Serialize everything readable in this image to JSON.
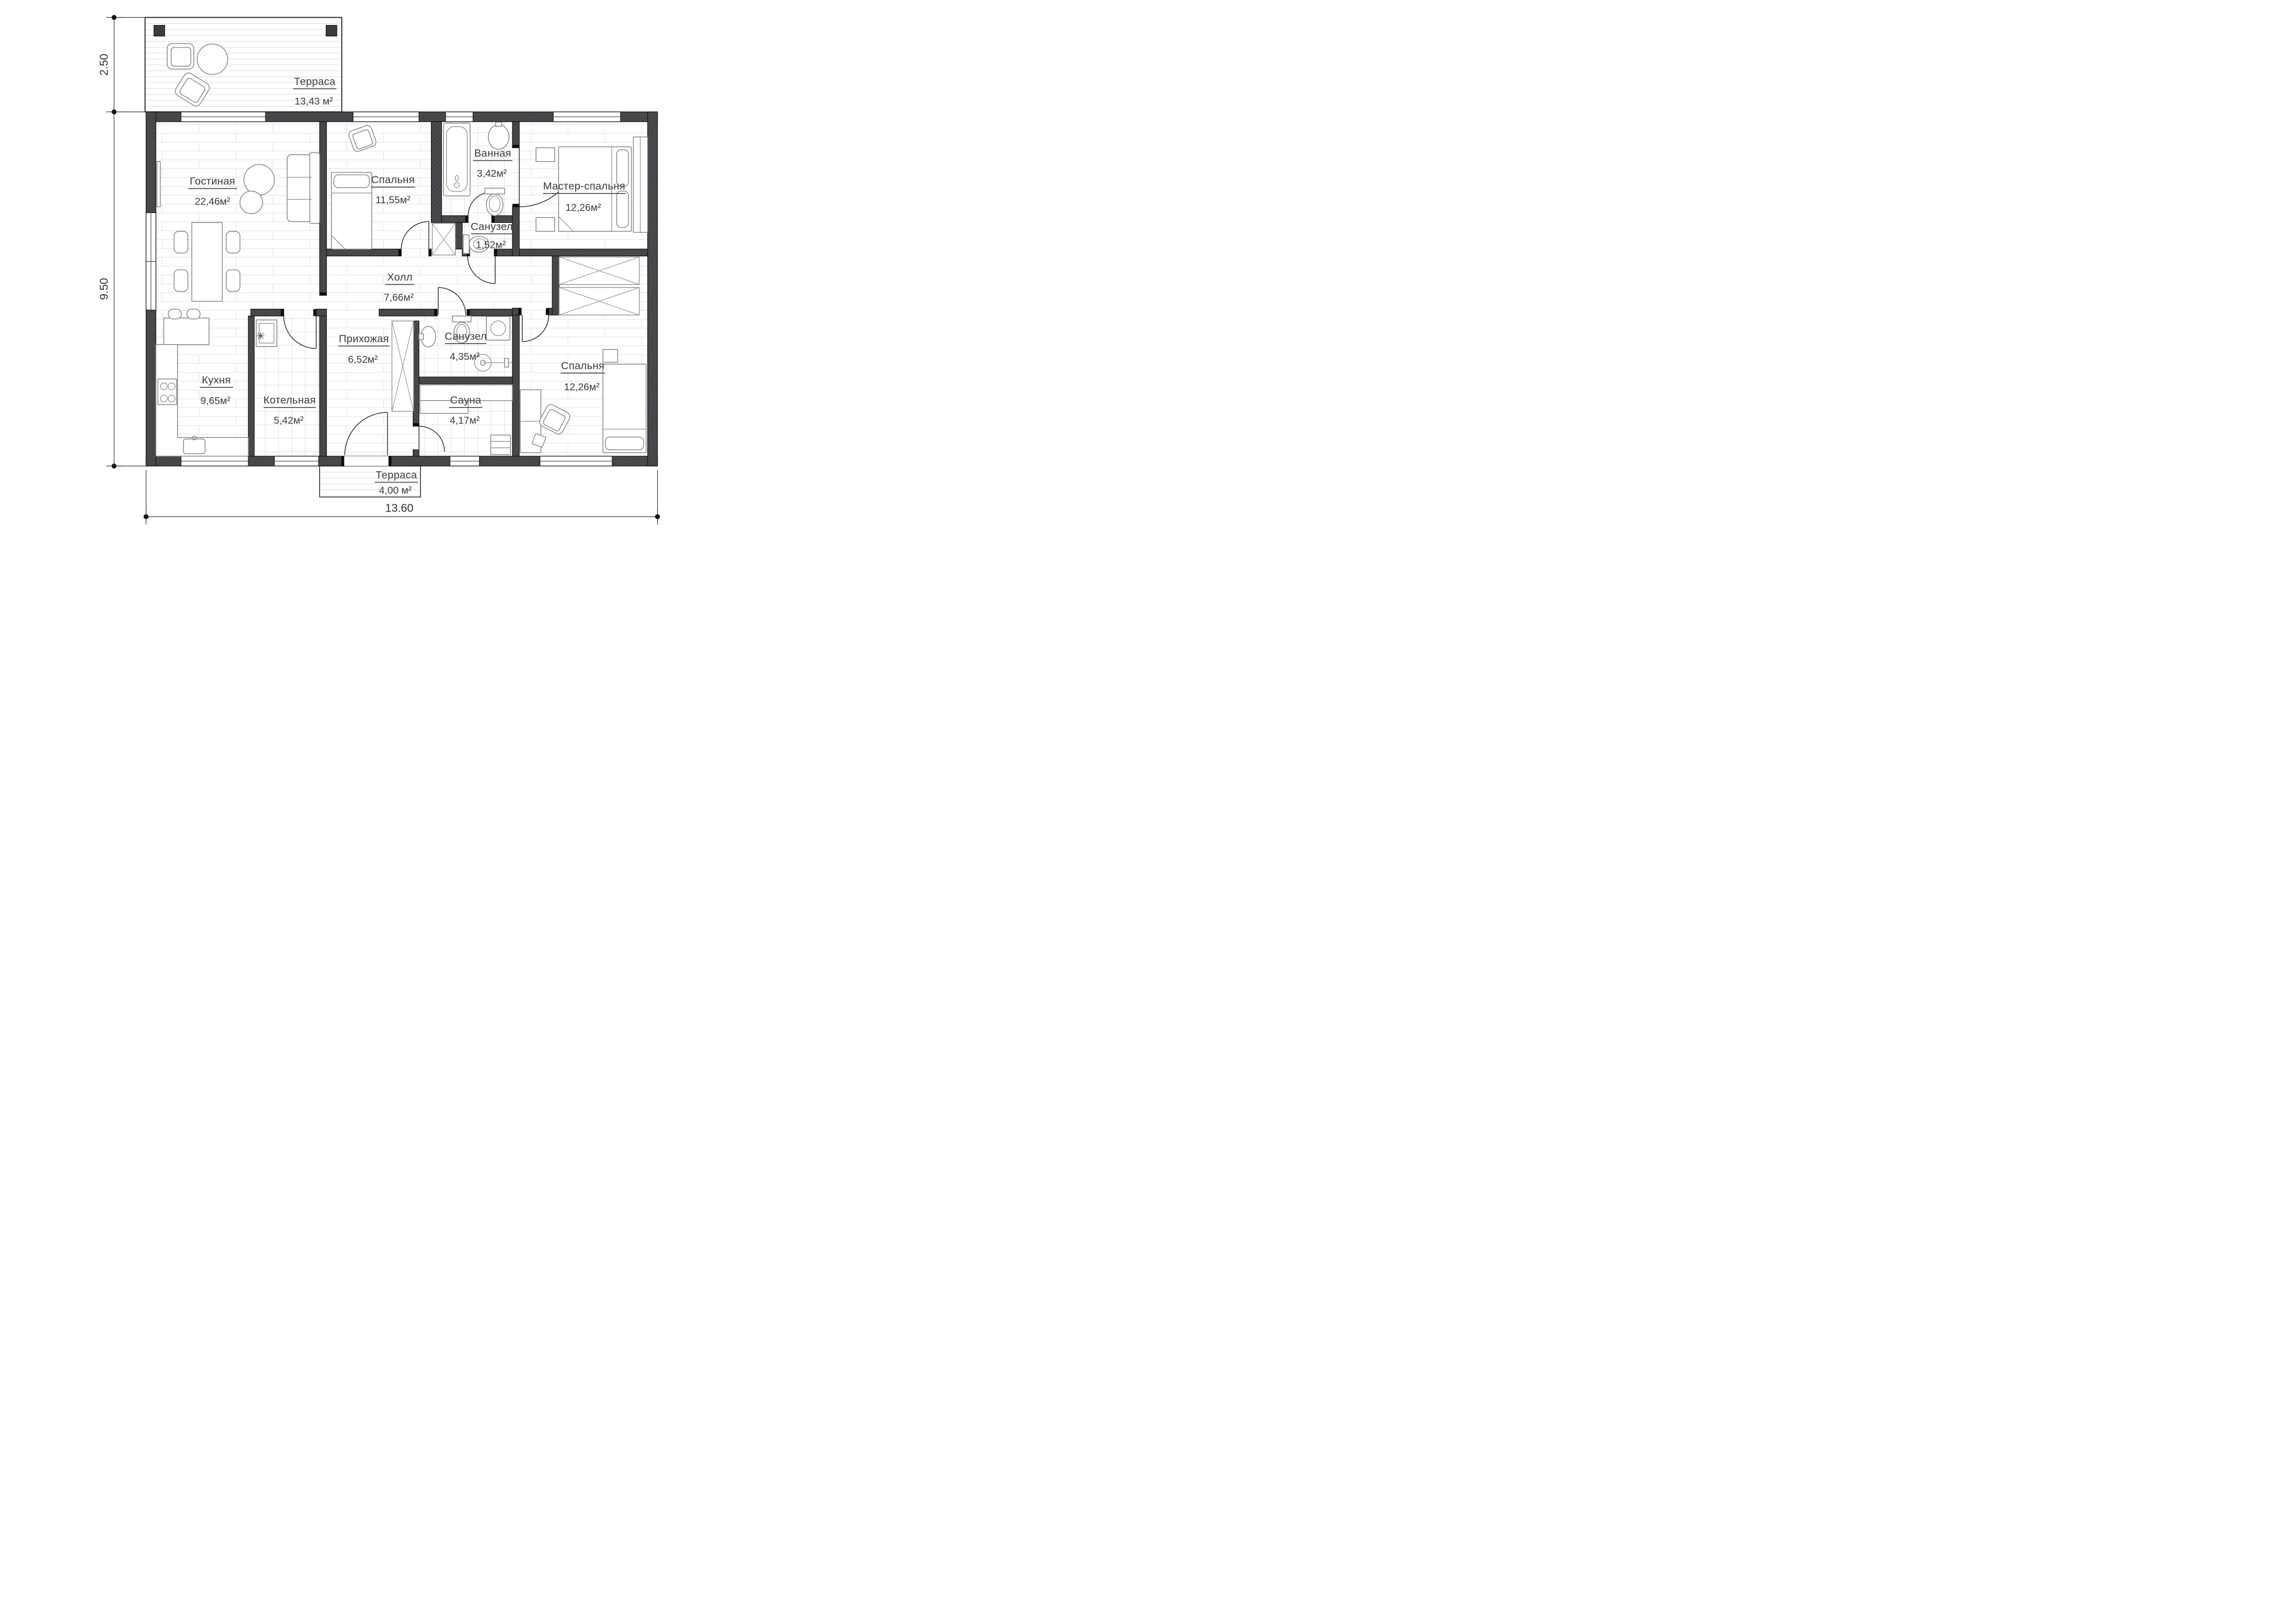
{
  "rooms": [
    {
      "id": "terrace-top",
      "name": "Терраса",
      "area": "13,43 м²"
    },
    {
      "id": "living",
      "name": "Гостиная",
      "area": "22,46м²"
    },
    {
      "id": "bedroom-top",
      "name": "Спальня",
      "area": "11,55м²"
    },
    {
      "id": "bathroom",
      "name": "Ванная",
      "area": "3,42м²"
    },
    {
      "id": "master-bedroom",
      "name": "Мастер-спальня",
      "area": "12,26м²"
    },
    {
      "id": "wc-small",
      "name": "Санузел",
      "area": "1,52м²"
    },
    {
      "id": "hall",
      "name": "Холл",
      "area": "7,66м²"
    },
    {
      "id": "entry",
      "name": "Прихожая",
      "area": "6,52м²"
    },
    {
      "id": "wc-big",
      "name": "Санузел",
      "area": "4,35м²"
    },
    {
      "id": "kitchen",
      "name": "Кухня",
      "area": "9,65м²"
    },
    {
      "id": "boiler-room",
      "name": "Котельная",
      "area": "5,42м²"
    },
    {
      "id": "sauna",
      "name": "Сауна",
      "area": "4,17м²"
    },
    {
      "id": "bedroom-bottom",
      "name": "Спальня",
      "area": "12,26м²"
    },
    {
      "id": "terrace-bottom",
      "name": "Терраса",
      "area": "4,00 м²"
    }
  ],
  "dims": {
    "terrace_height": "2.50",
    "house_height": "9.50",
    "house_width": "13.60"
  },
  "colors": {
    "wall": "#47474a",
    "line": "#141414",
    "furniture": "#878787",
    "floor_joint": "#e4e4e4",
    "text": "#3a3a3a"
  }
}
